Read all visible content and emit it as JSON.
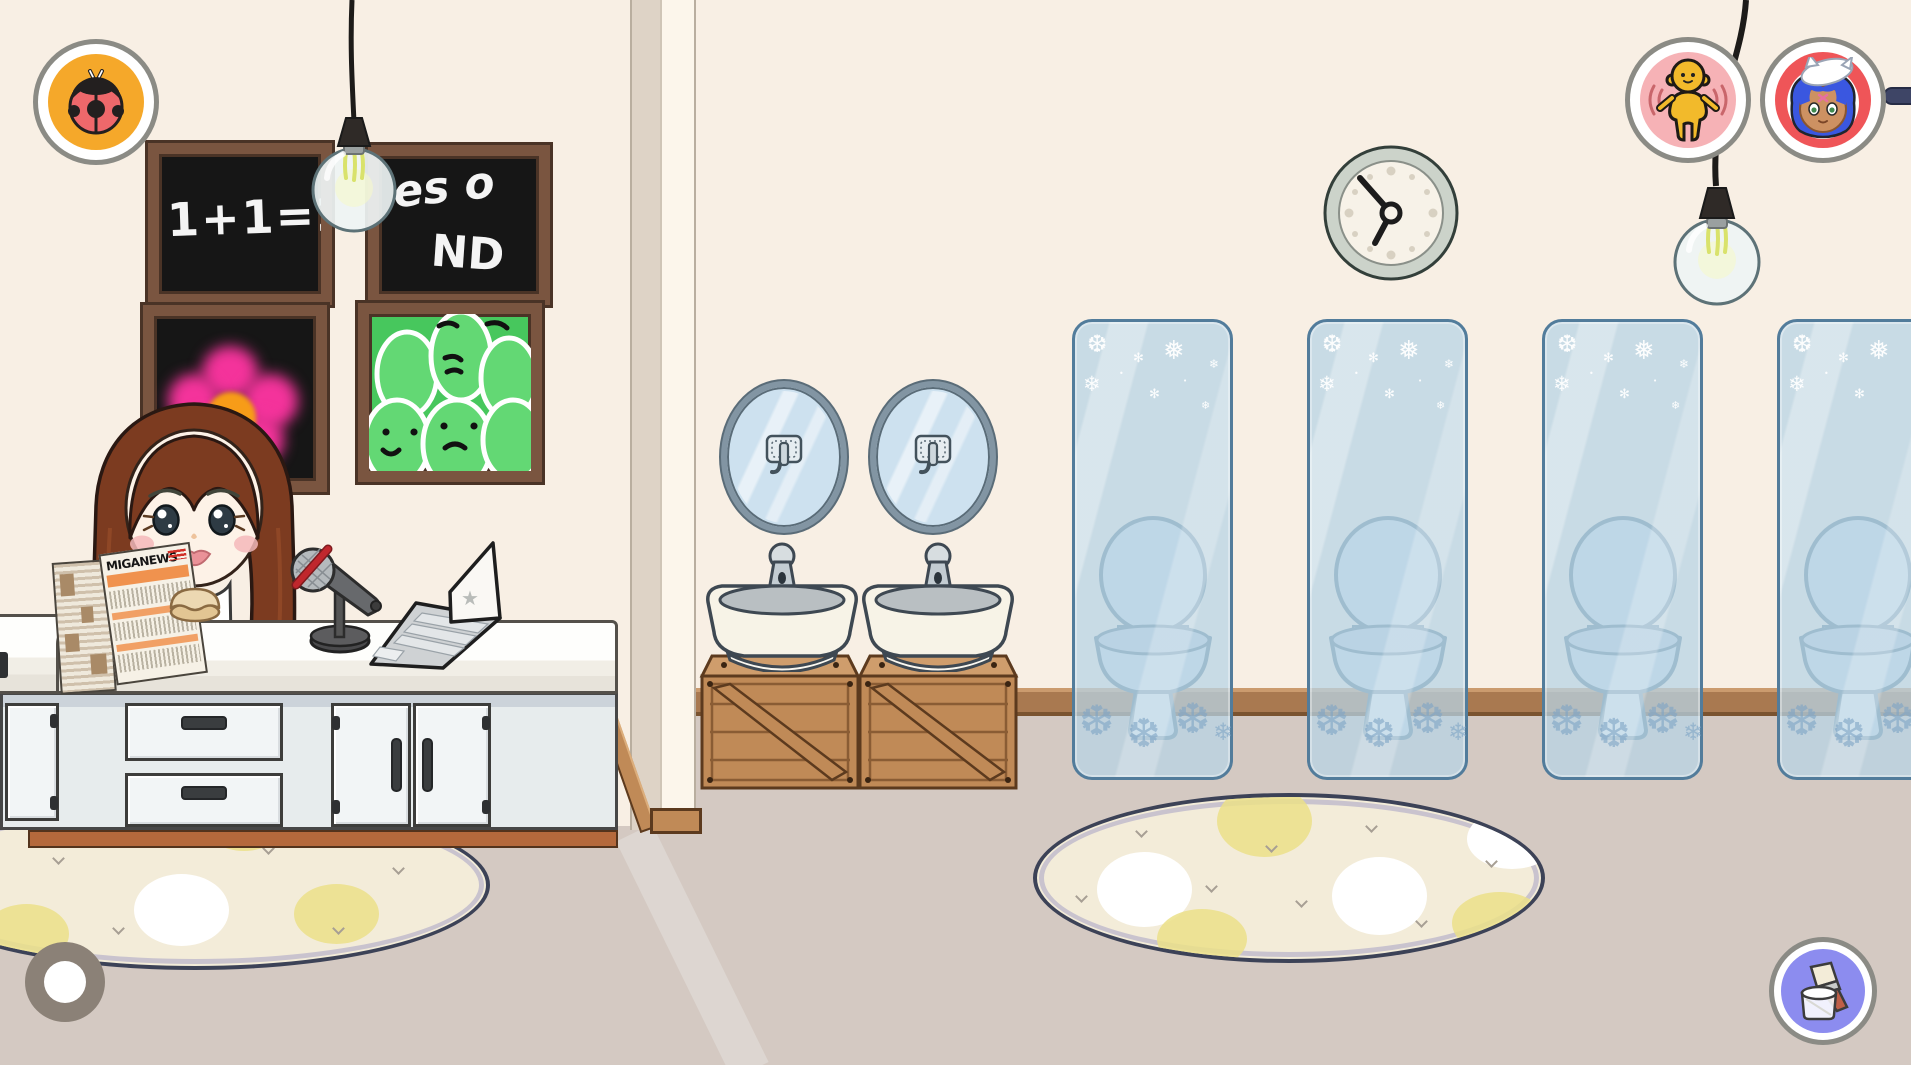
{
  "room": {
    "left_name": "news studio",
    "right_name": "bathroom"
  },
  "texts": {
    "board_math": "1+1=2",
    "board_answer_line1": "es o",
    "board_answer_line2": "ND",
    "newspaper_title": "MIGANEWS"
  },
  "icons": {
    "snowflake": "❄",
    "snowflake_heavy": "❆",
    "snowflake_open": "❅",
    "sparkle": "✻",
    "dot": "•",
    "star": "★"
  },
  "colors": {
    "wall": "#f8efe4",
    "wall_shade": "#ded3c6",
    "partition_face": "#fcf6eb",
    "floor": "#d4c9c2",
    "floor_band": "#ddd6d1",
    "rail": "#a97950",
    "rail_light": "#cb9b6e",
    "rail_dark": "#7a532f",
    "wood": "#c08a57",
    "wood_top": "#cf9d6c",
    "wood_dark": "#5c3a1e",
    "plank": "#8a5c34",
    "counter_line": "#54504a",
    "cabinet": "#e7eced",
    "cabinet_shade": "#ccd3da",
    "drawer": "#f2f5f6",
    "handle": "#3a3d3f",
    "plinth": "#b4693c",
    "plinth_dark": "#53331c",
    "board_frame": "#7a5540",
    "board_dark": "#4a3326",
    "chalk_bg": "#161616",
    "chalk": "#f4f4f4",
    "art_green": "#47c75d",
    "art_blob": "#63d874",
    "flower_pink": "#f4339b",
    "flower_orange": "#f79c18",
    "panel_glass": "rgba(183,212,229,0.74)",
    "panel_border": "#527c9b",
    "flake_blue": "rgba(125,164,196,0.6)",
    "toilet_fill": "#d2e1eb",
    "toilet_stroke": "#5a7b90",
    "toilet_rim": "#c2cfe0",
    "mirror_fill": "#cde1ef",
    "mirror_border": "#8295a3",
    "sink_white": "#f7f3e7",
    "chrome": "#ccd4d9",
    "chrome_dark": "#3e4852",
    "rug": "#f3ecd9",
    "rug_edge": "#3c4257",
    "rug_band": "#c9c3ce",
    "rug_yellow": "#ebe088",
    "mark_gray": "#a79f94",
    "ring_gray": "#8b8b85",
    "badge_orange": "#f5a82a",
    "ladybug": "#ee686b",
    "badge_pink": "#f6b2b6",
    "badge_red": "#ef5558",
    "badge_purple": "#8c8cef",
    "fig_yellow": "#f2ba2b",
    "wave": "#c9666b",
    "hair": "#7c3b20",
    "hair_line": "#2a1812",
    "skin": "#fdf2e7",
    "blush": "#f5b9ba",
    "lamp_glass": "#eef4f4",
    "lamp_stroke": "#5d7277",
    "filament": "#d9e26b",
    "cord": "#1d1b19",
    "clock_ring": "#ccd3ca",
    "clock_face": "#f7f2e8",
    "clock_dot": "#d8d1c2",
    "clock_line": "#333f3a",
    "navy": "#3e4566",
    "home_gray": "#8b8177",
    "news_orange": "#f0924e",
    "paper": "#f6f1e6",
    "blue_hair": "#3a57e0",
    "char_skin": "#cd9162"
  }
}
